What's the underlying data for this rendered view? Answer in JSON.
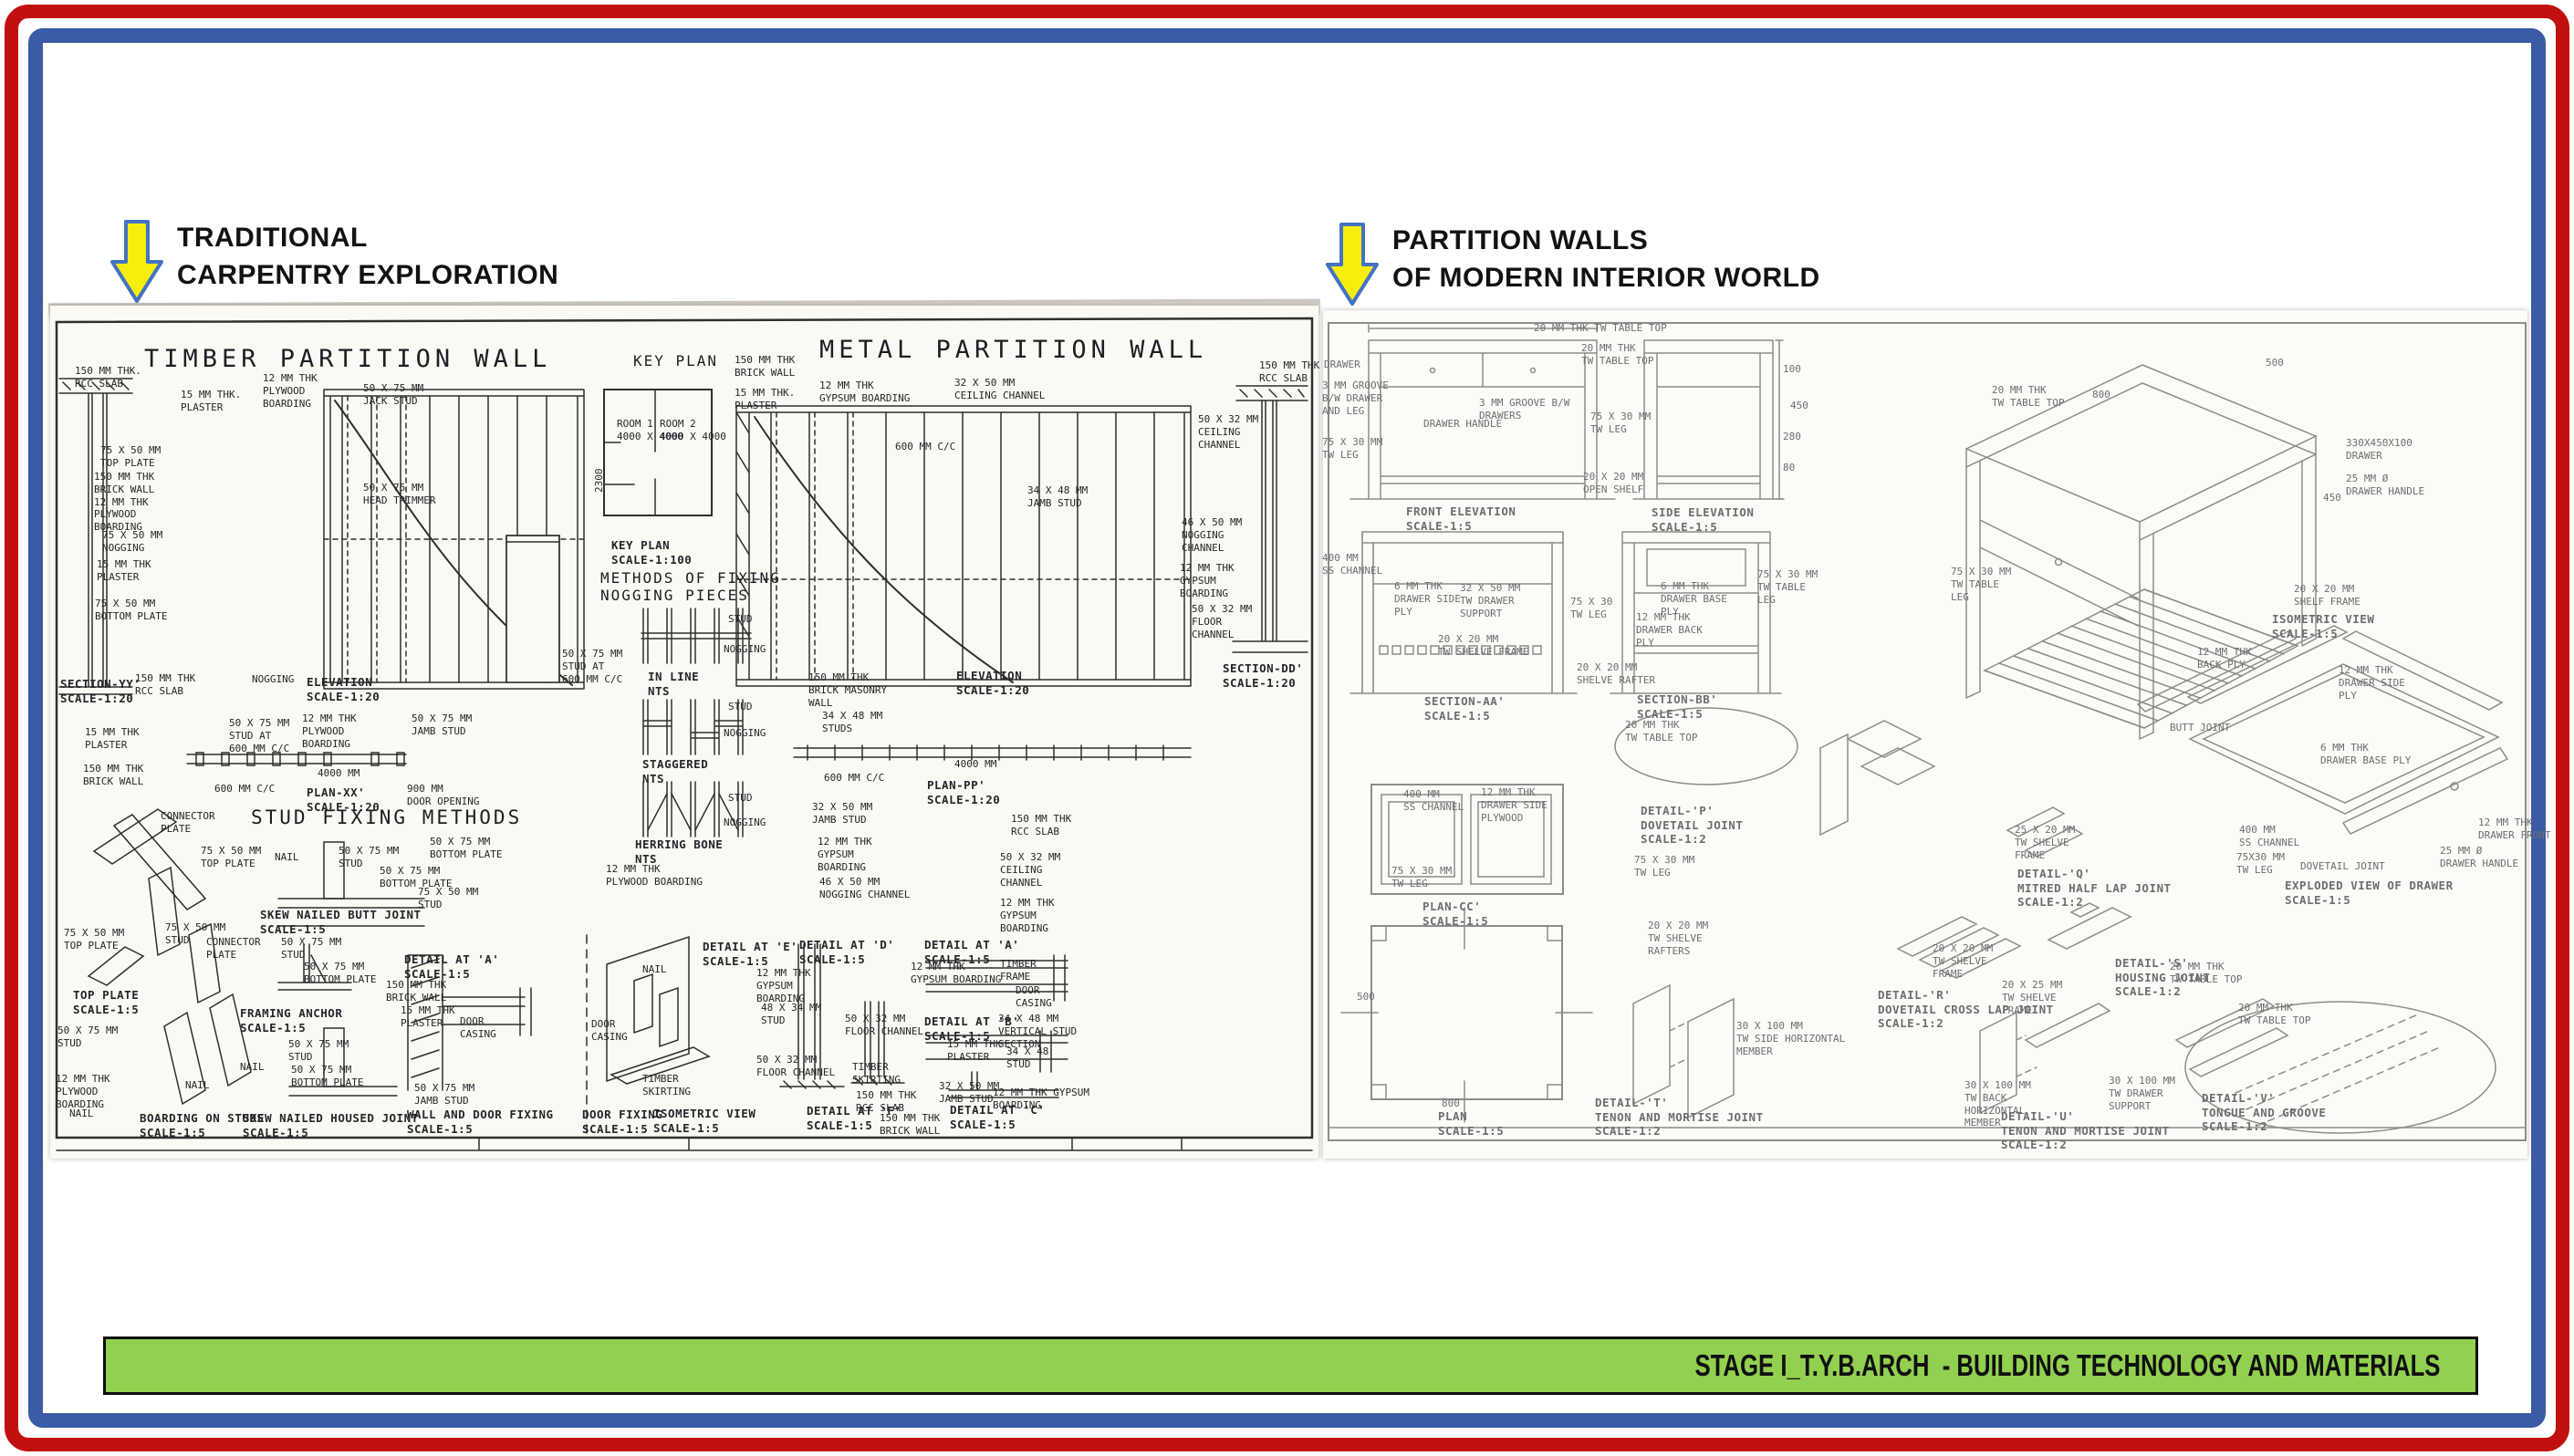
{
  "page": {
    "colors": {
      "outer_border": "#c20f0f",
      "inner_border": "#3a5ba5",
      "banner_green": "#92d050",
      "arrow_yellow": "#f8ee0d",
      "arrow_outline": "#4472c4",
      "ink_dark": "#26262a",
      "ink_faded": "#6e6e72"
    }
  },
  "headers": {
    "left": {
      "line1": "TRADITIONAL",
      "line2": "CARPENTRY EXPLORATION"
    },
    "right": {
      "line1": "PARTITION WALLS",
      "line2": "OF MODERN INTERIOR WORLD"
    }
  },
  "footer": {
    "banner": "STAGE I_T.Y.B.ARCH  - BUILDING TECHNOLOGY AND MATERIALS"
  },
  "left_sheet": {
    "titles": {
      "timber": "TIMBER PARTITION WALL",
      "key_plan": "KEY PLAN",
      "metal": "METAL PARTITION WALL",
      "methods": "METHODS OF FIXING\nNOGGING PIECES",
      "stud_fixing": "STUD FIXING METHODS"
    },
    "labels": [
      "150 MM THK.\nRCC SLAB",
      "75 X 50 MM\nTOP PLATE",
      "150 MM THK\nBRICK WALL\n12 MM THK\nPLYWOOD\nBOARDING",
      "75 X 50 MM\nNOGGING",
      "15 MM THK\nPLASTER",
      "75 X 50 MM\nBOTTOM PLATE",
      "SECTION-YY'\nSCALE-1:20",
      "150 MM THK\nRCC SLAB",
      "NOGGING",
      "15 MM THK.\nPLASTER",
      "12 MM THK\nPLYWOOD\nBOARDING",
      "50 X 75 MM\nJACK STUD",
      "50 X 75 MM\nHEAD TRIMMER",
      "ELEVATION\nSCALE-1:20",
      "50 X 75 MM\nSTUD AT\n600 MM C/C",
      "ROOM 1\n4000 X 4000",
      "ROOM 2\n4000 X 4000",
      "KEY PLAN\nSCALE-1:100",
      "STUD",
      "NOGGING",
      "IN LINE\nNTS",
      "STUD",
      "NOGGING",
      "STAGGERED\nNTS",
      "STUD",
      "NOGGING",
      "HERRING BONE\nNTS",
      "12 MM THK\nPLYWOOD BOARDING",
      "150 MM THK\nBRICK MASONRY\nWALL",
      "34 X 48 MM\nSTUDS",
      "600 MM C/C",
      "4000 MM",
      "PLAN-PP'\nSCALE-1:20",
      "32 X 50 MM\nJAMB STUD",
      "12 MM THK\nGYPSUM\nBOARDING",
      "46 X 50 MM\nNOGGING CHANNEL",
      "150 MM THK\nRCC SLAB",
      "50 X 32 MM\nCEILING\nCHANNEL",
      "12 MM THK\nGYPSUM\nBOARDING",
      "ELEVATION\nSCALE-1:20",
      "150 MM THK\nBRICK WALL",
      "15 MM THK.\nPLASTER",
      "12 MM THK\nGYPSUM BOARDING",
      "32 X 50 MM\nCEILING CHANNEL",
      "600 MM C/C",
      "34 X 48 MM\nJAMB STUD",
      "150 MM THK\nRCC SLAB",
      "50 X 32 MM\nCEILING\nCHANNEL",
      "46 X 50 MM\nNOGGING\nCHANNEL",
      "12 MM THK\nGYPSUM\nBOARDING",
      "50 X 32 MM\nFLOOR\nCHANNEL",
      "SECTION-DD'\nSCALE-1:20",
      "15 MM THK\nPLASTER",
      "150 MM THK\nBRICK WALL",
      "50 X 75 MM\nSTUD AT\n600 MM C/C",
      "12 MM THK\nPLYWOOD\nBOARDING",
      "50 X 75 MM\nJAMB STUD",
      "4000 MM",
      "600 MM C/C",
      "PLAN-XX'\nSCALE-1:20",
      "900 MM\nDOOR OPENING",
      "CONNECTOR\nPLATE",
      "75 X 50 MM\nTOP PLATE",
      "75 X 50 MM\nTOP PLATE",
      "75 X 50 MM\nSTUD",
      "NAIL",
      "50 X 75 MM\nSTUD",
      "50 X 75 MM\nBOTTOM PLATE",
      "50 X 75 MM\nBOTTOM PLATE",
      "75 X 50 MM\nSTUD",
      "SKEW NAILED BUTT JOINT\nSCALE-1:5",
      "TOP PLATE\nSCALE-1:5",
      "50 X 75 MM\nSTUD",
      "12 MM THK\nPLYWOOD\nBOARDING",
      "NAIL",
      "NAIL",
      "BOARDING ON STUDS\nSCALE-1:5",
      "CONNECTOR\nPLATE",
      "50 X 75 MM\nSTUD",
      "50 X 75 MM\nBOTTOM PLATE",
      "FRAMING ANCHOR\nSCALE-1:5",
      "50 X 75 MM\nSTUD",
      "NAIL",
      "50 X 75 MM\nBOTTOM PLATE",
      "SKEW NAILED HOUSED JOINT\nSCALE-1:5",
      "DETAIL AT 'A'\nSCALE-1:5",
      "150 MM THK\nBRICK WALL",
      "15 MM THK\nPLASTER",
      "DOOR\nCASING",
      "50 X 75 MM\nJAMB STUD",
      "WALL AND DOOR FIXING\nSCALE-1:5",
      "DOOR\nCASING",
      "DOOR FIXING\nSCALE-1:5",
      "NAIL",
      "DETAIL AT 'E'\nSCALE-1:5",
      "DETAIL AT 'D'\nSCALE-1:5",
      "DETAIL AT 'A'\nSCALE-1:5",
      "12 MM THK\nGYPSUM\nBOARDING",
      "48 X 34 MM\nSTUD",
      "50 X 32 MM\nFLOOR CHANNEL",
      "TIMBER\nSKIRTING",
      "ISOMETRIC VIEW\nSCALE-1:5",
      "50 X 32 MM\nFLOOR CHANNEL",
      "TIMBER\nSKIRTING",
      "DETAIL AT 'F'\nSCALE-1:5",
      "150 MM THK\nRCC SLAB",
      "150 MM THK\nBRICK WALL",
      "12 MM THK\nGYPSUM BOARDING",
      "TIMBER\nFRAME",
      "DOOR\nCASING",
      "DETAIL AT 'B'\nSCALE-1:5",
      "34 X 48 MM\nVERTICAL STUD\nSECTION",
      "15 MM THK\nPLASTER",
      "32 X 50 MM\nJAMB STUD",
      "34 X 48\nSTUD",
      "12 MM THK GYPSUM\nBOARDING",
      "DETAIL AT 'C'\nSCALE-1:5",
      "2300"
    ]
  },
  "right_sheet": {
    "labels": [
      "20 MM THK TW TABLE TOP",
      "20 MM THK\nTW TABLE TOP",
      "DRAWER",
      "3 MM GROOVE\nB/W DRAWER\nAND LEG",
      "75 X 30 MM\nTW LEG",
      "3 MM GROOVE B/W\nDRAWERS",
      "DRAWER HANDLE",
      "75 X 30 MM\nTW LEG",
      "20 X 20 MM\nOPEN SHELF",
      "FRONT ELEVATION\nSCALE-1:5",
      "SIDE ELEVATION\nSCALE-1:5",
      "100",
      "450",
      "280",
      "80",
      "400 MM\nSS CHANNEL",
      "6 MM THK\nDRAWER SIDE\nPLY",
      "32 X 50 MM\nTW DRAWER\nSUPPORT",
      "75 X 30\nTW LEG",
      "20 X 20 MM\nTW SHELVE FRAME",
      "20 X 20 MM\nSHELVE RAFTER",
      "SECTION-AA'\nSCALE-1:5",
      "6 MM THK\nDRAWER BASE\nPLY",
      "12 MM THK\nDRAWER BACK\nPLY",
      "75 X 30 MM\nTW TABLE\nLEG",
      "SECTION-BB'\nSCALE-1:5",
      "20 MM THK\nTW TABLE TOP",
      "400 MM\nSS CHANNEL",
      "12 MM THK\nDRAWER SIDE\nPLYWOOD",
      "75 X 30 MM\nTW LEG",
      "PLAN-CC'\nSCALE-1:5",
      "800",
      "500",
      "PLAN\nSCALE-1:5",
      "DETAIL-'P'\nDOVETAIL JOINT\nSCALE-1:2",
      "75 X 30 MM\nTW LEG",
      "20 X 20 MM\nTW SHELVE\nRAFTERS",
      "DETAIL-'T'\nTENON AND MORTISE JOINT\nSCALE-1:2",
      "30 X 100 MM\nTW SIDE HORIZONTAL\nMEMBER",
      "DETAIL-'R'\nDOVETAIL CROSS LAP JOINT\nSCALE-1:2",
      "20 X 20 MM\nTW SHELVE\nFRAME",
      "20 X 25 MM\nTW SHELVE\nFRAME",
      "DETAIL-'S'\nHOUSING JOINT\nSCALE-1:2",
      "30 X 100 MM\nTW BACK\nHORIZONTAL\nMEMBER",
      "DETAIL-'U'\nTENON AND MORTISE JOINT\nSCALE-1:2",
      "30 X 100 MM\nTW DRAWER\nSUPPORT",
      "20 MM THK\nTW TABLE TOP",
      "DETAIL-'V'\nTONGUE AND GROOVE\nSCALE-1:2",
      "20 MM THK\nTW TABLE TOP",
      "800",
      "500",
      "330X450X100\nDRAWER",
      "25 MM Ø\nDRAWER HANDLE",
      "450",
      "75 X 30 MM\nTW TABLE\nLEG",
      "20 X 20 MM\nSHELF FRAME",
      "ISOMETRIC VIEW\nSCALE-1:5",
      "12 MM THK\nBACK PLY",
      "12 MM THK\nDRAWER SIDE\nPLY",
      "BUTT JOINT",
      "6 MM THK\nDRAWER BASE PLY",
      "400 MM\nSS CHANNEL",
      "75X30 MM\nTW LEG",
      "DOVETAIL JOINT",
      "12 MM THK\nDRAWER FRONT",
      "25 MM Ø\nDRAWER HANDLE",
      "EXPLODED VIEW OF DRAWER\nSCALE-1:5",
      "25 X 20 MM\nTW SHELVE\nFRAME",
      "DETAIL-'Q'\nMITRED HALF LAP JOINT\nSCALE-1:2",
      "20 MM THK\nTW TABLE TOP"
    ]
  }
}
